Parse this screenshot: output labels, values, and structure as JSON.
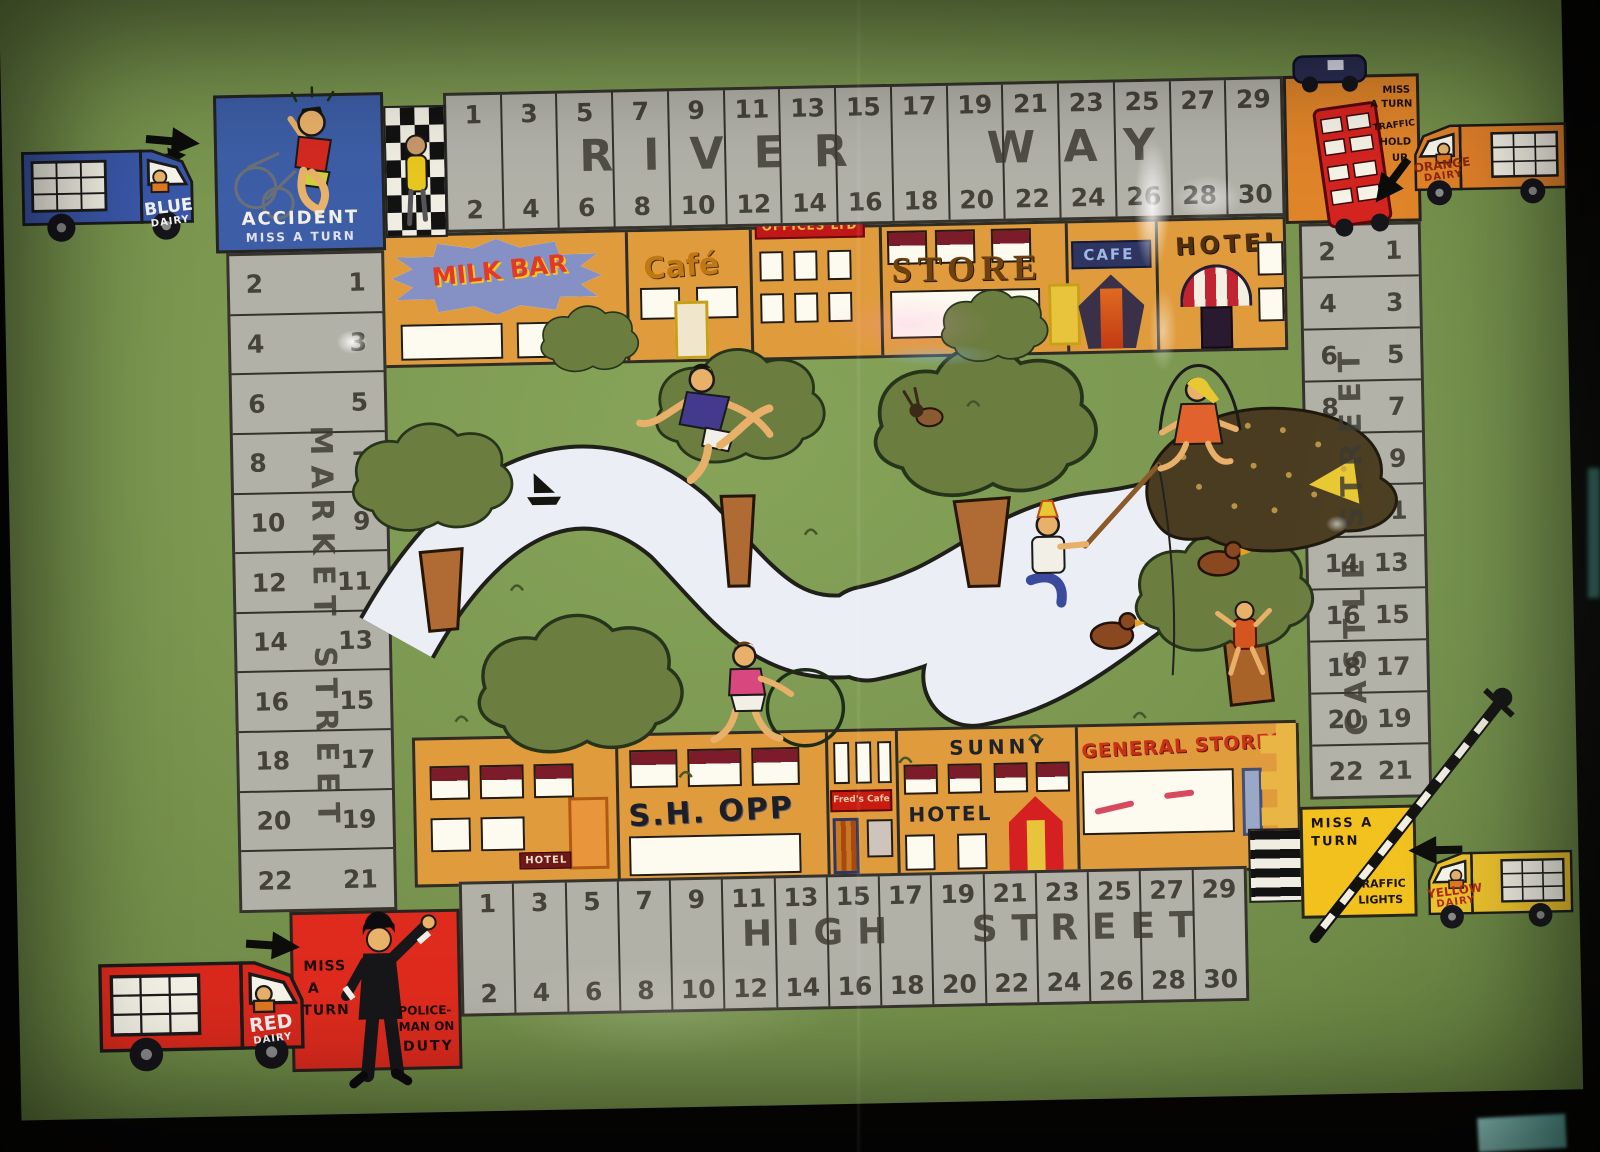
{
  "scene": {
    "bg": "#070605",
    "board_green": "#7b9750",
    "track_grey": "#b2b1a8",
    "shop_orange": "#e09b3c",
    "river_white": "#eceef5"
  },
  "streets": {
    "top": {
      "name": "RIVER WAY",
      "odds": [
        1,
        3,
        5,
        7,
        9,
        11,
        13,
        15,
        17,
        19,
        21,
        23,
        25,
        27,
        29
      ],
      "evens": [
        2,
        4,
        6,
        8,
        10,
        12,
        14,
        16,
        18,
        20,
        22,
        24,
        26,
        28,
        30
      ]
    },
    "bottom": {
      "name": "HIGH STREET",
      "odds": [
        1,
        3,
        5,
        7,
        9,
        11,
        13,
        15,
        17,
        19,
        21,
        23,
        25,
        27,
        29
      ],
      "evens": [
        2,
        4,
        6,
        8,
        10,
        12,
        14,
        16,
        18,
        20,
        22,
        24,
        26,
        28,
        30
      ]
    },
    "left": {
      "name": "MARKET STREET",
      "odds": [
        1,
        3,
        5,
        7,
        9,
        11,
        13,
        15,
        17,
        19,
        21
      ],
      "evens": [
        2,
        4,
        6,
        8,
        10,
        12,
        14,
        16,
        18,
        20,
        22
      ]
    },
    "right": {
      "name": "CASTLE STREET",
      "odds": [
        1,
        3,
        5,
        7,
        9,
        11,
        13,
        15,
        17,
        19,
        21
      ],
      "evens": [
        2,
        4,
        6,
        8,
        10,
        12,
        14,
        16,
        18,
        20,
        22
      ]
    }
  },
  "corners": {
    "accident": {
      "bg": "#3d5ea6",
      "lines": [
        "ACCIDENT",
        "MISS A TURN"
      ]
    },
    "hold_up": {
      "bg": "#df8429",
      "lines": [
        "MISS",
        "A TURN",
        "TRAFFIC",
        "HOLD",
        "UP"
      ]
    },
    "lights": {
      "bg": "#f2c11d",
      "lines": [
        "MISS A",
        "TURN",
        "TRAFFIC",
        "LIGHTS"
      ]
    },
    "police": {
      "bg": "#df2b1e",
      "lines": [
        "MISS",
        "A",
        "TURN",
        "POLICE-",
        "MAN ON",
        "DUTY"
      ]
    }
  },
  "shops_top": {
    "milk_bar": "MILK BAR",
    "cafe1": "Café",
    "offices": "OFFICES LTD",
    "store": "STORE",
    "cafe2": "CAFE",
    "hotel": "HOTEL"
  },
  "shops_bottom": {
    "hotel_small": "HOTEL",
    "shopp": "S.H. OPP",
    "freds": "Fred's Cafe",
    "sunny1": "SUNNY",
    "sunny2": "HOTEL",
    "general": "GENERAL STORES"
  },
  "vans": {
    "blue": {
      "name": "BLUE",
      "sub": "DAIRY",
      "color": "#3a57a8"
    },
    "orange": {
      "name": "ORANGE",
      "sub": "DAIRY",
      "color": "#e0802a"
    },
    "red": {
      "name": "RED",
      "sub": "DAIRY",
      "color": "#da291c"
    },
    "yellow": {
      "name": "YELLOW",
      "sub": "DAIRY",
      "color": "#eec32b"
    }
  }
}
